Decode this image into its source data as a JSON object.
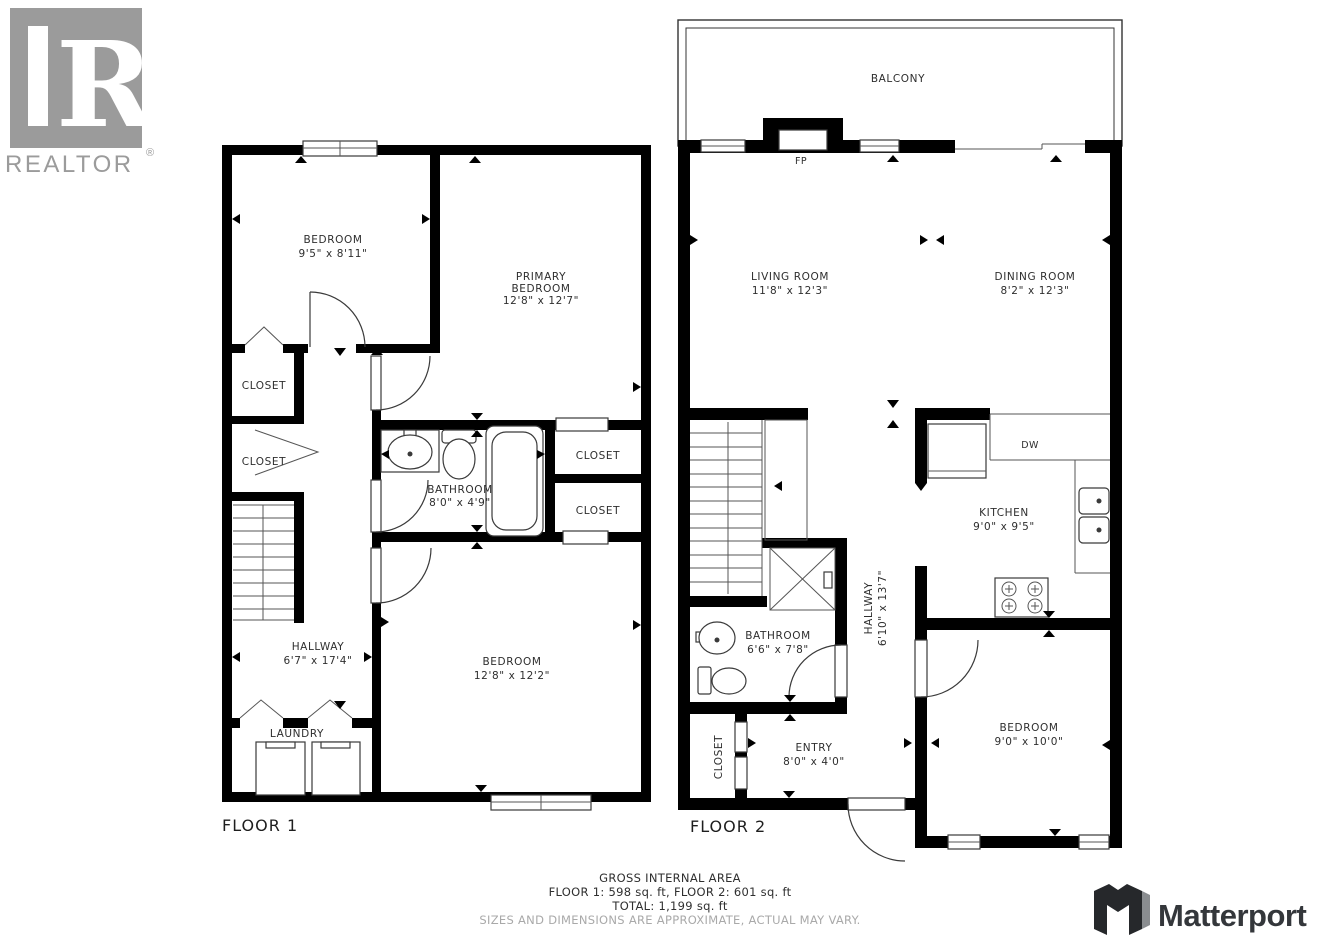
{
  "branding": {
    "realtor": {
      "letter": "R",
      "wordmark": "REALTOR",
      "registered": "®"
    },
    "matterport": {
      "wordmark": "Matterport"
    }
  },
  "floor1": {
    "label": "FLOOR 1",
    "rooms": {
      "bedroom1": {
        "name": "BEDROOM",
        "dims": "9'5\" x 8'11\""
      },
      "primary": {
        "name_line1": "PRIMARY",
        "name_line2": "BEDROOM",
        "dims": "12'8\" x 12'7\""
      },
      "closet_left_upper": {
        "name": "CLOSET"
      },
      "closet_left_lower": {
        "name": "CLOSET"
      },
      "bathroom": {
        "name": "BATHROOM",
        "dims": "8'0\" x 4'9\""
      },
      "closet_right_upper": {
        "name": "CLOSET"
      },
      "closet_right_lower": {
        "name": "CLOSET"
      },
      "hallway": {
        "name": "HALLWAY",
        "dims": "6'7\" x 17'4\""
      },
      "bedroom2": {
        "name": "BEDROOM",
        "dims": "12'8\" x 12'2\""
      },
      "laundry": {
        "name": "LAUNDRY"
      }
    }
  },
  "floor2": {
    "label": "FLOOR 2",
    "rooms": {
      "balcony": {
        "name": "BALCONY"
      },
      "fireplace": {
        "name": "FP"
      },
      "living": {
        "name": "LIVING ROOM",
        "dims": "11'8\" x 12'3\""
      },
      "dining": {
        "name": "DINING ROOM",
        "dims": "8'2\" x 12'3\""
      },
      "kitchen": {
        "name": "KITCHEN",
        "dims": "9'0\" x 9'5\""
      },
      "dishwasher": {
        "name": "DW"
      },
      "hallway": {
        "name": "HALLWAY",
        "dims": "6'10\" x 13'7\""
      },
      "bathroom": {
        "name": "BATHROOM",
        "dims": "6'6\" x 7'8\""
      },
      "closet": {
        "name": "CLOSET"
      },
      "entry": {
        "name": "ENTRY",
        "dims": "8'0\" x 4'0\""
      },
      "bedroom": {
        "name": "BEDROOM",
        "dims": "9'0\" x 10'0\""
      }
    }
  },
  "footer": {
    "gross_area_title": "GROSS INTERNAL AREA",
    "floors_line": "FLOOR 1: 598 sq. ft, FLOOR 2: 601 sq. ft",
    "total_line": "TOTAL: 1,199 sq. ft",
    "disclaimer": "SIZES AND DIMENSIONS ARE APPROXIMATE, ACTUAL MAY VARY."
  },
  "colors": {
    "wall": "#000000",
    "fixture_line": "#3a3a3a",
    "label_text": "#2e2e2e",
    "muted_text": "#a9a9a9",
    "realtor_gray": "#9b9b9b",
    "matterport_dark": "#34373b",
    "background": "#ffffff"
  }
}
